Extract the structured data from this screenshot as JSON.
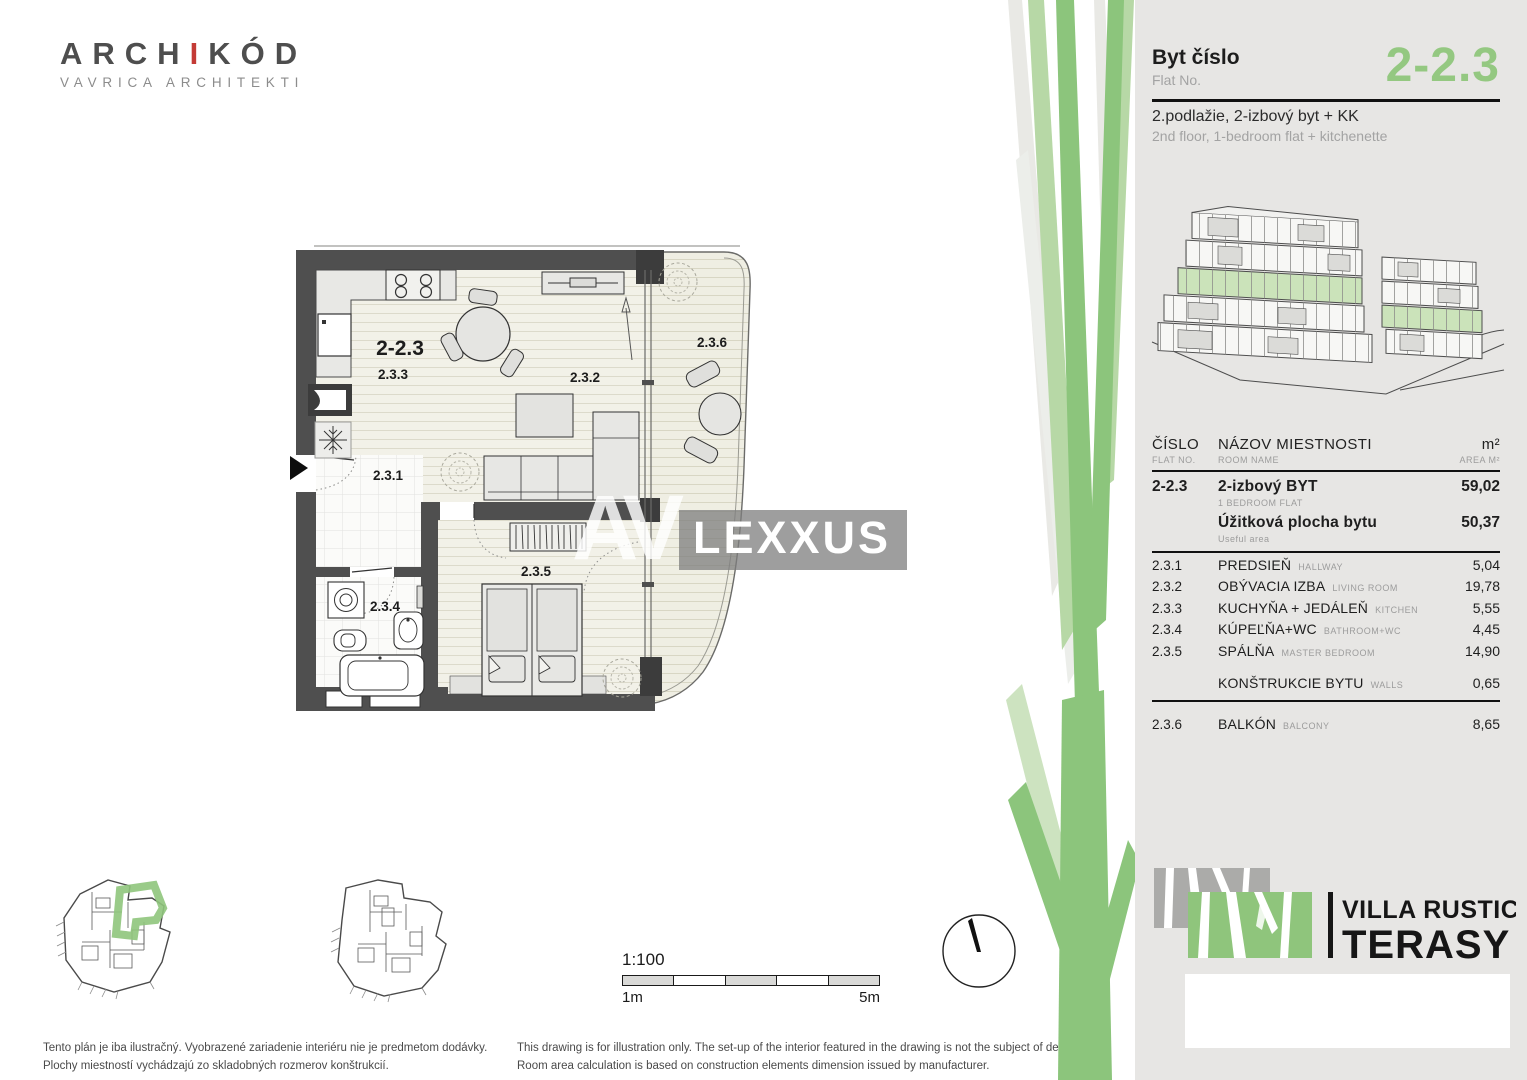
{
  "branding": {
    "archikod": {
      "pre": "ARCH",
      "accent": "I",
      "post": "KÓD",
      "sub": "VAVRICA ARCHITEKTI"
    },
    "villa_rustica": {
      "line1": "VILLA RUSTICA",
      "line2": "TERASY"
    }
  },
  "colors": {
    "accent_green": "#8fc57c",
    "flat_number_green": "#94c881",
    "panel_gray": "#e7e6e4",
    "wall_gray": "#4f4f4f",
    "archikod_red": "#c43b36"
  },
  "header": {
    "flat_label_sk": "Byt číslo",
    "flat_label_en": "Flat No.",
    "flat_number": "2-2.3",
    "subtitle_sk": "2.podlažie, 2-izbový byt + KK",
    "subtitle_en": "2nd floor, 1-bedroom flat + kitchenette"
  },
  "floor_plan": {
    "flat_number": "2-2.3",
    "rooms": {
      "hallway": "2.3.1",
      "living": "2.3.2",
      "kitchen": "2.3.3",
      "bathroom": "2.3.4",
      "bedroom": "2.3.5",
      "balcony": "2.3.6"
    }
  },
  "watermark": {
    "av": "AV",
    "lexxus": "LEXXUS"
  },
  "area_table": {
    "headers": {
      "col1_sk": "ČÍSLO",
      "col1_en": "FLAT NO.",
      "col2_sk": "NÁZOV  MIESTNOSTI",
      "col2_en": "ROOM NAME",
      "col3_sk": "m²",
      "col3_en": "AREA M²"
    },
    "rows": [
      {
        "no": "2-2.3",
        "name_sk": "2-izbový BYT",
        "name_en": "1 BEDROOM FLAT",
        "area": "59,02",
        "bold": true,
        "two_line": true
      },
      {
        "no": "",
        "name_sk": "Úžitková plocha bytu",
        "name_en": "Useful area",
        "area": "50,37",
        "bold": true,
        "two_line": true,
        "divider_after": true
      },
      {
        "no": "2.3.1",
        "name_sk": "PREDSIEŇ",
        "name_en": "HALLWAY",
        "area": "5,04"
      },
      {
        "no": "2.3.2",
        "name_sk": "OBÝVACIA IZBA",
        "name_en": "LIVING ROOM",
        "area": "19,78"
      },
      {
        "no": "2.3.3",
        "name_sk": "KUCHYŇA + JEDÁLEŇ",
        "name_en": "KITCHEN",
        "area": "5,55"
      },
      {
        "no": "2.3.4",
        "name_sk": "KÚPEĽŇA+WC",
        "name_en": "BATHROOM+WC",
        "area": "4,45"
      },
      {
        "no": "2.3.5",
        "name_sk": "SPÁLŇA",
        "name_en": "MASTER BEDROOM",
        "area": "14,90"
      },
      {
        "no": "",
        "name_sk": "KONŠTRUKCIE BYTU",
        "name_en": "WALLS",
        "area": "0,65",
        "gap_before": true,
        "divider_after": true
      },
      {
        "no": "2.3.6",
        "name_sk": "BALKÓN",
        "name_en": "BALCONY",
        "area": "8,65",
        "gap_before": true
      }
    ]
  },
  "scale": {
    "ratio": "1:100",
    "from": "1m",
    "to": "5m"
  },
  "disclaimer_sk": {
    "line1": "Tento plán je iba ilustračný. Vyobrazené zariadenie interiéru nie je predmetom dodávky.",
    "line2": "Plochy miestností vychádzajú zo skladobných rozmerov konštrukcií."
  },
  "disclaimer_en": {
    "line1": "This drawing is for illustration only. The set-up of the interior featured in the drawing is not the subject of delivery.",
    "line2": "Room area calculation is based on construction elements dimension issued by manufacturer."
  }
}
